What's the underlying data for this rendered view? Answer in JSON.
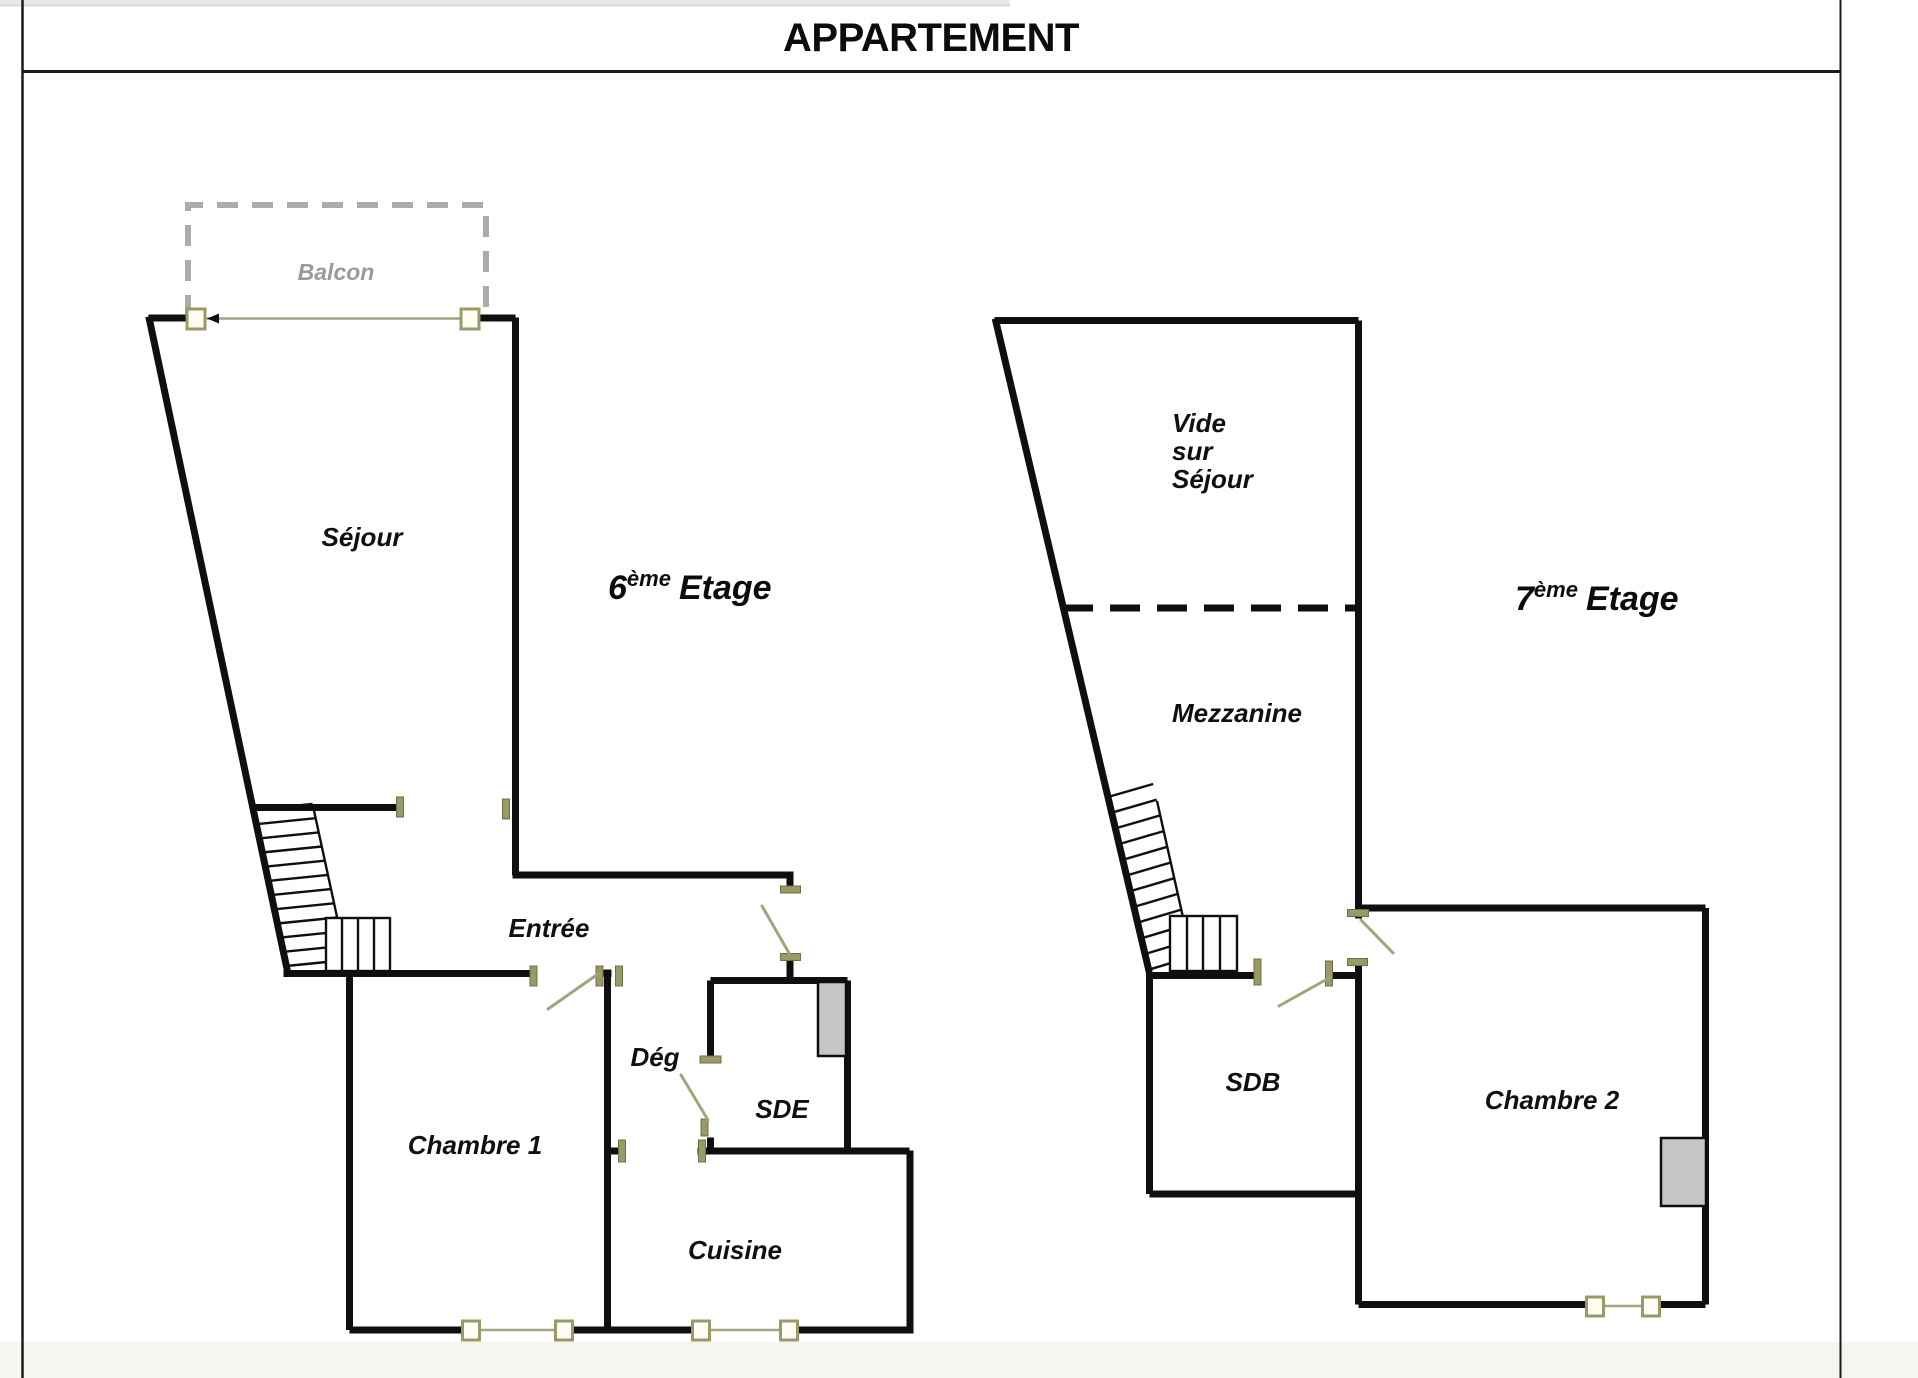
{
  "page": {
    "title": "APPARTEMENT"
  },
  "floor6": {
    "name": "6ème Etage",
    "label": {
      "base": "6",
      "sup": "ème",
      "word": "Etage"
    },
    "rooms": {
      "balcon": "Balcon",
      "sejour": "Séjour",
      "entree": "Entrée",
      "chambre1": "Chambre 1",
      "deg": "Dég",
      "sde": "SDE",
      "cuisine": "Cuisine"
    }
  },
  "floor7": {
    "name": "7ème Etage",
    "label": {
      "base": "7",
      "sup": "ème",
      "word": "Etage"
    },
    "rooms": {
      "vide": {
        "line1": "Vide",
        "line2": "sur",
        "line3": "Séjour"
      },
      "mezzanine": "Mezzanine",
      "sdb": "SDB",
      "chambre2": "Chambre 2"
    }
  },
  "colors": {
    "wall": "#0f0f0f",
    "frame": "#9a9a66",
    "frame_fill": "#fffef4",
    "swing": "#a3a37c",
    "balcony": "#ababab",
    "balcony_text": "#9a9a9a",
    "fixture": "#c6c6c6",
    "border": "#1c1c1c",
    "topstrip": "#e9e9e9",
    "bottomstrip": "#f6f5f2"
  }
}
